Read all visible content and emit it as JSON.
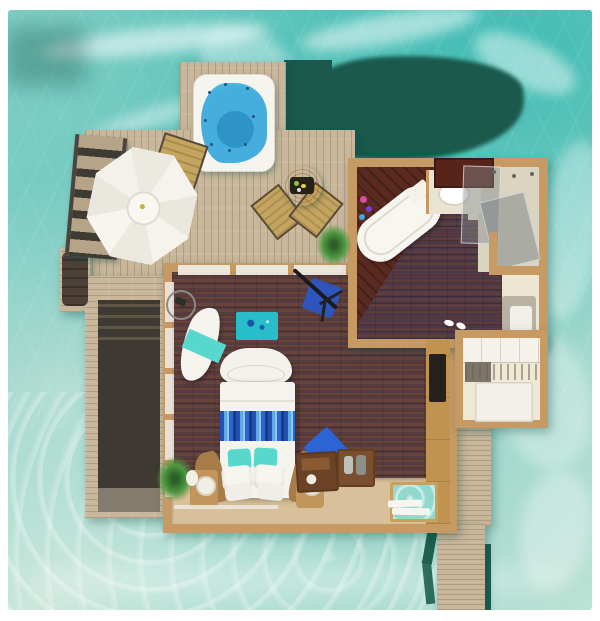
{
  "figure": {
    "kind": "overwater-villa-floor-plan-rendering",
    "areas": [
      "ocean",
      "sun-deck",
      "jacuzzi",
      "parasol-lounge",
      "water-stairs",
      "outdoor-dining",
      "bedroom",
      "bathroom",
      "walk-in-closet",
      "jetty-walkway",
      "glass-floor-panel"
    ]
  },
  "colors": {
    "ocean_base": "#7FCEC4",
    "ocean_deep": "#1A594C",
    "ocean_pale": "#CDE8DD",
    "foam": "#FFFFFF",
    "deck": "#C9B79B",
    "deck_recess": "#3E3933",
    "wall": "#C79A63",
    "floor": "#53403C",
    "bath_floor": "#EDE6D3",
    "tub_platform": "#5A2A20",
    "tub": "#F7F6F1",
    "jacuzzi_blue": "#45AEDE",
    "jacuzzi_deep": "#2E93C8",
    "teal_accent": "#58D8CC",
    "rug_teal": "#27BEC9",
    "runner_blue": "#2C68CC",
    "chair_blue": "#2B64D4",
    "table_orange": "#C87F32",
    "chair_tan": "#C4A45E",
    "plant": "#4E9840",
    "pile_green": "#1E5F50",
    "linen": "#F4F3ED",
    "sand": "#D8C09A",
    "wood_box": "#6B4226",
    "tv_screen": "#26211E"
  }
}
